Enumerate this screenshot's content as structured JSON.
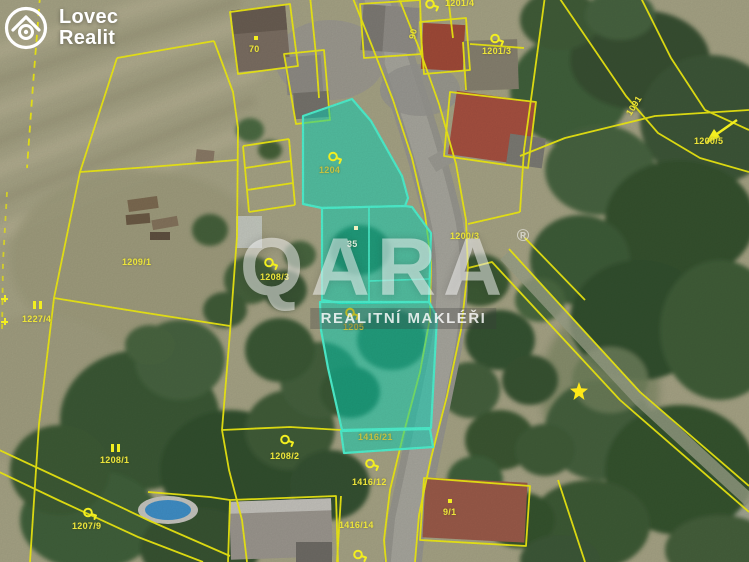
{
  "logo": {
    "line1": "Lovec",
    "line2": "Realit"
  },
  "watermark": {
    "brand": "QARA",
    "registered": "®",
    "subtitle": "REALITNÍ MAKLÉŘI"
  },
  "colors": {
    "cadastral_line": "#f2ee12",
    "highlight_fill": "#00dcbe",
    "highlight_stroke": "#4ef2cf",
    "label_yellow": "#ece43a"
  },
  "map": {
    "type": "cadastral-aerial",
    "highlighted_parcels": [
      "1204",
      "35",
      "1205",
      "1416/21"
    ],
    "symbol_types": [
      "key-marker",
      "grassland-marker",
      "dot-marker",
      "star-marker",
      "arrow-marker"
    ],
    "labels": [
      {
        "text": "70"
      },
      {
        "text": "90"
      },
      {
        "text": "1201/4"
      },
      {
        "text": "1201/3"
      },
      {
        "text": "1200/3"
      },
      {
        "text": "1091"
      },
      {
        "text": "1200/5"
      },
      {
        "text": "1209/1"
      },
      {
        "text": "1227/4"
      },
      {
        "text": "1208/3"
      },
      {
        "text": "1204"
      },
      {
        "text": "35"
      },
      {
        "text": "1205"
      },
      {
        "text": "1416/21"
      },
      {
        "text": "1416/12"
      },
      {
        "text": "1416/14"
      },
      {
        "text": "1208/1"
      },
      {
        "text": "1208/2"
      },
      {
        "text": "1207/9"
      },
      {
        "text": "9/1"
      }
    ]
  }
}
